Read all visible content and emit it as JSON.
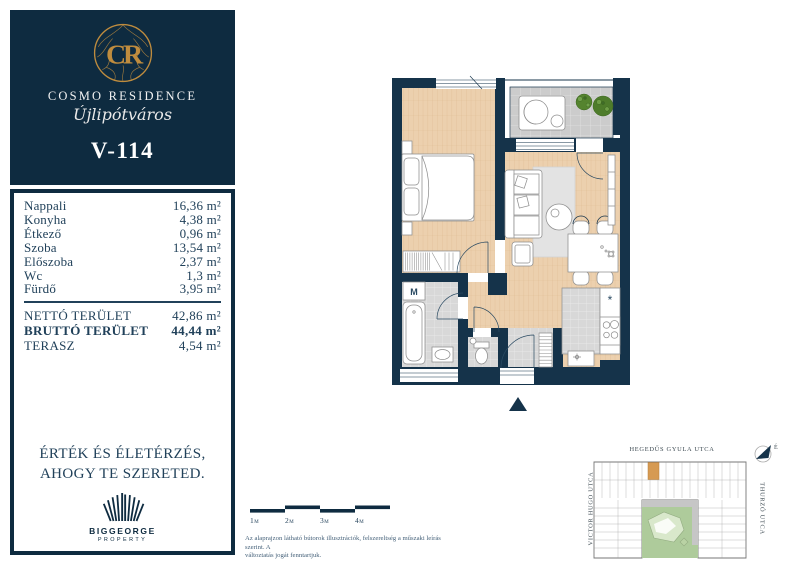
{
  "brand": {
    "monogram": "CR",
    "name": "COSMO RESIDENCE",
    "subtitle": "Újlipótváros"
  },
  "unit": {
    "id": "V-114"
  },
  "rooms": [
    {
      "label": "Nappali",
      "value": "16,36 m²"
    },
    {
      "label": "Konyha",
      "value": "4,38 m²"
    },
    {
      "label": "Étkező",
      "value": "0,96 m²"
    },
    {
      "label": "Szoba",
      "value": "13,54 m²"
    },
    {
      "label": "Előszoba",
      "value": "2,37 m²"
    },
    {
      "label": "Wc",
      "value": "1,3 m²"
    },
    {
      "label": "Fürdő",
      "value": "3,95 m²"
    }
  ],
  "totals": [
    {
      "label": "NETTÓ TERÜLET",
      "value": "42,86 m²"
    },
    {
      "label": "BRUTTÓ TERÜLET",
      "value": "44,44 m²"
    },
    {
      "label": "TERASZ",
      "value": "4,54 m²"
    }
  ],
  "motto": {
    "line1": "ÉRTÉK ÉS ÉLETÉRZÉS,",
    "line2": "AHOGY TE SZERETED."
  },
  "developer": {
    "name": "BIGGEORGE",
    "division": "PROPERTY"
  },
  "scalebar": {
    "labels": [
      "1m",
      "2m",
      "3m",
      "4m"
    ]
  },
  "disclaimer": {
    "line1": "Az alaprajzon látható bútorok illusztrációk, felszereltség a műszaki leírás szerint. A",
    "line2": "változtatás jogát fenntartjuk."
  },
  "floorplan": {
    "washer_label": "M",
    "kitchen_symbol": "*"
  },
  "sitemap": {
    "street_top": "HEGEDŰS GYULA UTCA",
    "street_left": "VICTOR HUGO UTCA",
    "street_right": "THURZÓ UTCA",
    "compass_label": "É"
  },
  "colors": {
    "navy": "#0e2b40",
    "wall_navy": "#15334a",
    "gold": "#bf8c3e",
    "wood_floor": "#ecd0ae",
    "tile_gray": "#d8d8d8",
    "highlight_unit": "#d69a52",
    "courtyard_green": "#aecb9b"
  }
}
